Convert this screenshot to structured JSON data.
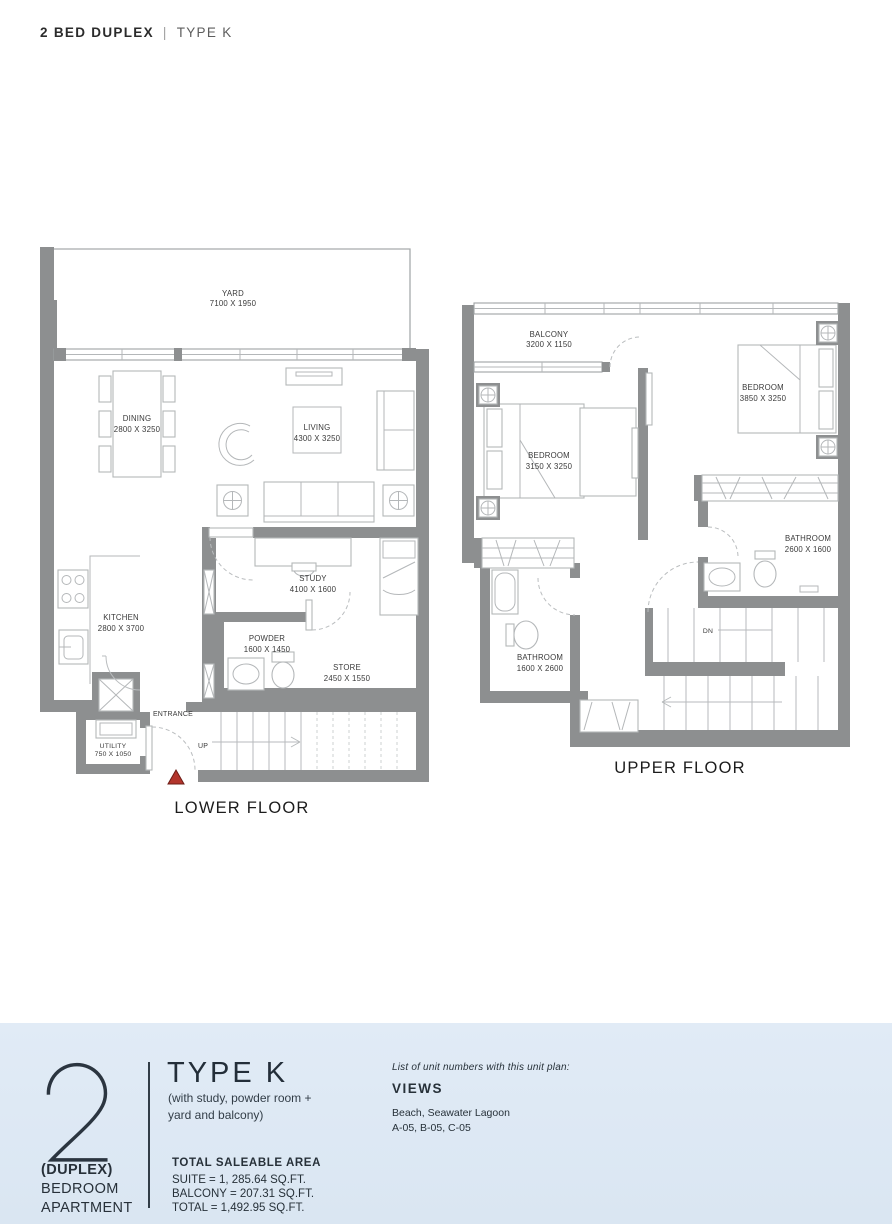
{
  "header": {
    "title": "2 BED DUPLEX",
    "separator": "|",
    "subtitle": "TYPE K"
  },
  "colors": {
    "wall_gray": "#8d8f90",
    "footer_bg": "#dde8f3",
    "entrance_marker_red": "#b3352c",
    "text_dark": "#27313b"
  },
  "lower_floor": {
    "caption": "LOWER FLOOR",
    "entrance_label": "ENTRANCE",
    "stairs_label": "UP",
    "rooms": {
      "yard": {
        "name": "YARD",
        "dims": "7100 X 1950"
      },
      "dining": {
        "name": "DINING",
        "dims": "2800 X 3250"
      },
      "living": {
        "name": "LIVING",
        "dims": "4300 X 3250"
      },
      "kitchen": {
        "name": "KITCHEN",
        "dims": "2800 X 3700"
      },
      "study": {
        "name": "STUDY",
        "dims": "4100 X 1600"
      },
      "powder": {
        "name": "POWDER",
        "dims": "1600 X 1450"
      },
      "store": {
        "name": "STORE",
        "dims": "2450 X 1550"
      },
      "utility": {
        "name": "UTILITY",
        "dims": "750 X 1050"
      }
    }
  },
  "upper_floor": {
    "caption": "UPPER FLOOR",
    "stairs_label": "DN",
    "rooms": {
      "balcony": {
        "name": "BALCONY",
        "dims": "3200 X 1150"
      },
      "bedroom_left": {
        "name": "BEDROOM",
        "dims": "3150 X 3250"
      },
      "bedroom_right": {
        "name": "BEDROOM",
        "dims": "3850 X 3250"
      },
      "bathroom_right": {
        "name": "BATHROOM",
        "dims": "2600 X 1600"
      },
      "bathroom_left": {
        "name": "BATHROOM",
        "dims": "1600 X 2600"
      }
    }
  },
  "footer": {
    "unit_count": "2",
    "unit_line1": "(DUPLEX)",
    "unit_line2": "BEDROOM",
    "unit_line3": "APARTMENT",
    "type_title": "TYPE K",
    "type_note_line1": "(with study, powder room +",
    "type_note_line2": "yard and balcony)",
    "area_heading": "TOTAL SALEABLE AREA",
    "area_lines": [
      "SUITE = 1, 285.64 SQ.FT.",
      "BALCONY = 207.31 SQ.FT.",
      "TOTAL = 1,492.95 SQ.FT."
    ],
    "views_intro": "List of unit numbers with this unit plan:",
    "views_heading": "VIEWS",
    "views_line1": "Beach, Seawater Lagoon",
    "views_line2": "A-05, B-05, C-05"
  }
}
